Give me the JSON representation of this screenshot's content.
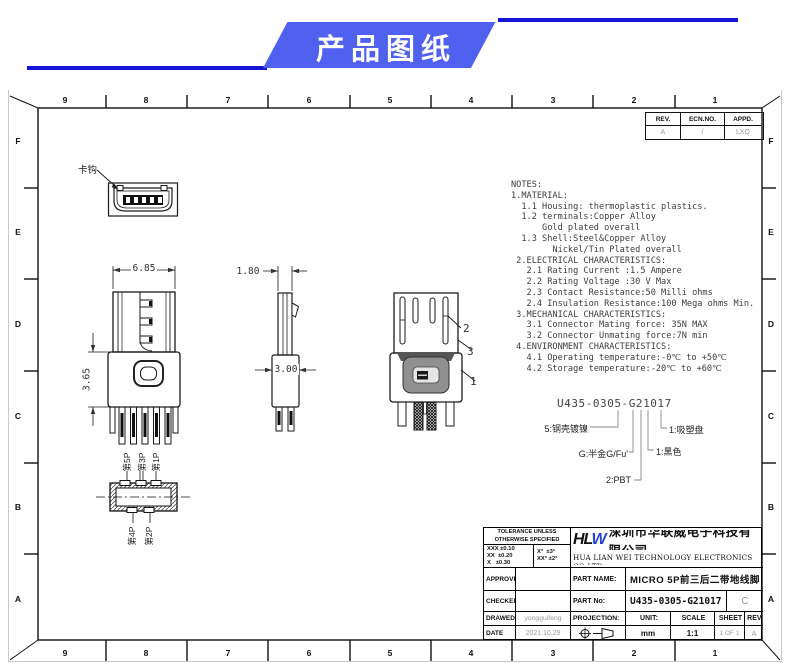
{
  "banner": {
    "title": "产品图纸",
    "accent_color": "#1414d2",
    "fill_color": "#5060ef"
  },
  "sheet": {
    "zone_cols": [
      "9",
      "8",
      "7",
      "6",
      "5",
      "4",
      "3",
      "2",
      "1"
    ],
    "zone_rows": [
      "F",
      "E",
      "D",
      "C",
      "B",
      "A"
    ]
  },
  "rev_table": {
    "headers": [
      "REV.",
      "ECN.NO.",
      "APPD."
    ],
    "values": [
      "A",
      "/",
      "LXQ"
    ]
  },
  "views": {
    "front": {
      "hook_label": "卡钩"
    },
    "main": {
      "width_dim": "6.85",
      "height_dim": "3.65"
    },
    "side": {
      "top_width_dim": "1.80",
      "bottom_width_dim": "3.00"
    },
    "perspective": {
      "callout_1": "1",
      "callout_2": "2",
      "callout_3": "3"
    },
    "bottom": {
      "pin_labels_top": [
        "第5P",
        "第3P",
        "第1P"
      ],
      "pin_labels_bottom": [
        "第4P",
        "第2P"
      ]
    }
  },
  "notes": {
    "lines": [
      "NOTES:",
      "1.MATERIAL:",
      "  1.1 Housing: thermoplastic plastics.",
      "  1.2 terminals:Copper Alloy",
      "      Gold plated overall",
      "  1.3 Shell:Steel&Copper Alloy",
      "        Nickel/Tin Plated overall",
      " 2.ELECTRICAL CHARACTERISTICS:",
      "   2.1 Rating Current :1.5 Ampere",
      "   2.2 Rating Voltage :30 V Max",
      "   2.3 Contact Resistance:50 Milli ohms",
      "   2.4 Insulation Resistance:100 Mega ohms Min.",
      " 3.MECHANICAL CHARACTERISTICS:",
      "   3.1 Connector Mating force: 35N MAX",
      "   3.2 Connector Unmating force:7N min",
      " 4.ENVIRONMENT CHARACTERISTICS:",
      "   4.1 Operating temperature:-0℃ to +50℃",
      "   4.2 Storage temperature:-20℃ to +60℃"
    ]
  },
  "part_code": {
    "code": "U435-0305-G21017",
    "shell_label": "5:钢壳镀镍",
    "plating_label": "G:半金G/Fu'",
    "material_label": "2:PBT",
    "color_label": "1:黑色",
    "packing_label": "1:吸塑盘"
  },
  "title_block": {
    "tolerance": {
      "header_lines": [
        "TOLERANCE UNLESS",
        "OTHERWISE SPECIFIED"
      ],
      "linear": [
        "XXX ±0.10",
        "XX  ±0.20",
        "X   ±0.30"
      ],
      "angular": [
        "X°  ±3°",
        "XX° ±2°"
      ]
    },
    "company": {
      "logo_hl": "HL",
      "logo_w": "W",
      "name_cn": "深圳市华联威电子科技有限公司",
      "name_en": "HUA LIAN WEI TECHNOLOGY ELECTRONICS CO:LTD."
    },
    "approved_label": "APPROVED",
    "approved_value": "",
    "checked_label": "CHECKED",
    "checked_value": "",
    "drawed_label": "DRAWED",
    "drawed_value": "yongguifeng",
    "date_label": "DATE",
    "date_value": "2021.10.29",
    "part_name_label": "PART NAME:",
    "part_name_value": "MICRO 5P前三后二带地线脚",
    "part_no_label": "PART No:",
    "part_no_value": "U435-0305-G21017",
    "revision_letter": "C",
    "projection_label": "PROJECTION:",
    "unit_label": "UNIT:",
    "unit_value": "mm",
    "scale_label": "SCALE",
    "scale_value": "1:1",
    "sheet_label": "SHEET",
    "sheet_value": "1 OF 1",
    "rev_label": "REV.",
    "rev_value": "A"
  }
}
